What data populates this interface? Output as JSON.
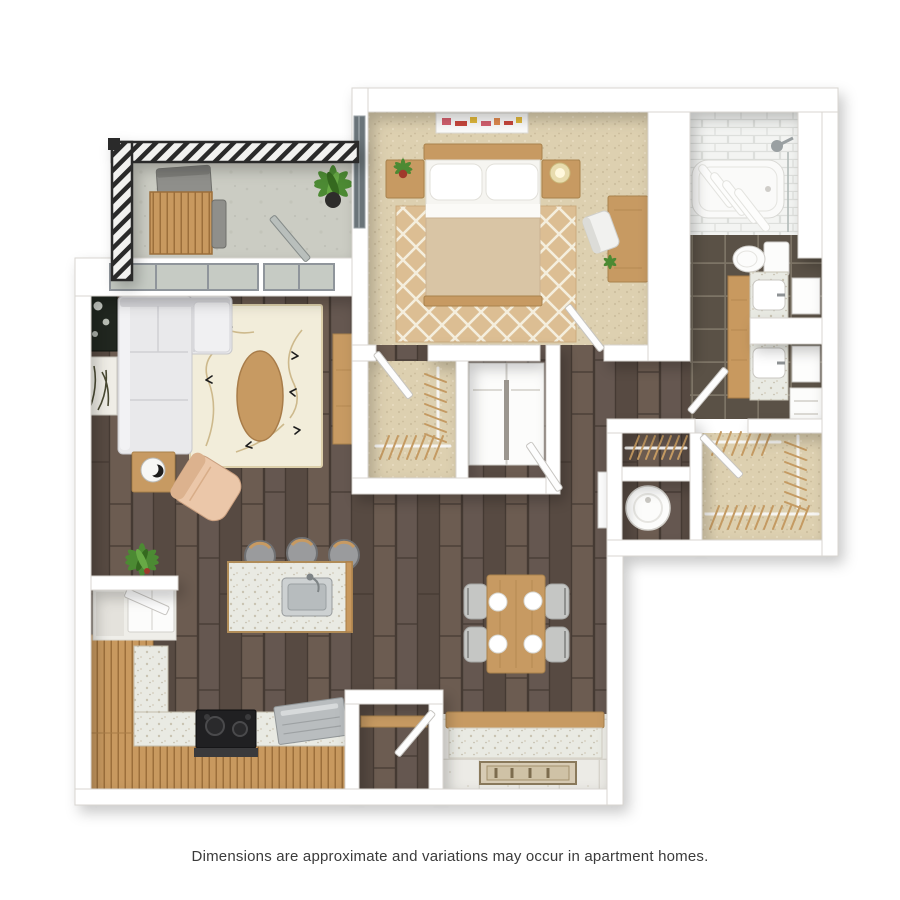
{
  "caption": {
    "text": "Dimensions are approximate and variations may occur in apartment homes."
  },
  "palette": {
    "wall": "#ffffff",
    "wall_edge": "#d8d5d0",
    "wood_floor": "#5e5148",
    "carpet": "#ddd0b0",
    "tile_dark": "#5a5146",
    "tile_grout": "#7d7466",
    "shower_tile": "#f3f4f2",
    "balcony_floor": "#cbccc3",
    "railing": "#2c2c2c",
    "cabinet_wood": "#c8995f",
    "furniture_wood": "#c79a62",
    "counter_speckle": "#e9eae3",
    "sofa": "#e9e9eb",
    "accent_chair": "#ebc7a9",
    "rug_cream": "#f2edda",
    "rug_tan": "#dcbe93",
    "appliance_steel": "#b9bdbf",
    "stove_black": "#202022",
    "door": "#fdfdfd",
    "door_edge": "#c6c4c0",
    "glass": "#c6cbc4",
    "window_frame": "#8f959b",
    "plant_green": "#4c8a33",
    "hanger_wood": "#c49a62",
    "blanket_tan": "#d9c5a5",
    "text": "#3b3b3b"
  },
  "floor_plan": {
    "type": "3d-top-down-apartment-floor-plan",
    "rooms": [
      {
        "name": "balcony",
        "floor": "concrete",
        "items": [
          "railing",
          "bistro-table",
          "patio-chair",
          "potted-plant",
          "glass-door"
        ]
      },
      {
        "name": "living-room",
        "floor": "dark-hardwood",
        "items": [
          "sectional-sofa",
          "area-rug",
          "oval-coffee-table",
          "side-table",
          "accent-chair",
          "wall-art",
          "wall-art",
          "media-console",
          "potted-plant",
          "windows"
        ]
      },
      {
        "name": "kitchen",
        "floor": "dark-hardwood",
        "items": [
          "l-shaped-counter",
          "range-stove",
          "dishwasher",
          "refrigerator",
          "island-with-sink",
          "bar-stool",
          "bar-stool",
          "bar-stool"
        ]
      },
      {
        "name": "dining-area",
        "floor": "dark-hardwood",
        "items": [
          "dining-table",
          "dining-chair",
          "dining-chair",
          "dining-chair",
          "dining-chair",
          "place-setting",
          "place-setting",
          "place-setting",
          "place-setting"
        ]
      },
      {
        "name": "entry",
        "floor": "tile",
        "items": [
          "pony-wall",
          "doormat",
          "pantry-closet",
          "pantry-door"
        ]
      },
      {
        "name": "bedroom",
        "floor": "carpet",
        "items": [
          "bed",
          "pillows",
          "nightstand",
          "nightstand",
          "table-lamp",
          "potted-plant",
          "trellis-rug",
          "desk",
          "desk-chair",
          "wall-art",
          "wall-art",
          "window",
          "door"
        ]
      },
      {
        "name": "bedroom-closet",
        "floor": "carpet",
        "items": [
          "wire-shelving",
          "door"
        ]
      },
      {
        "name": "laundry-closet",
        "floor": "",
        "items": [
          "washer",
          "dryer"
        ]
      },
      {
        "name": "hallway",
        "floor": "dark-hardwood",
        "items": [
          "door"
        ]
      },
      {
        "name": "bathroom",
        "floor": "dark-tile",
        "items": [
          "tub-shower",
          "shower-curtain",
          "shower-head",
          "toilet",
          "vanity",
          "sink",
          "sink",
          "mirror",
          "mirror",
          "linen-cabinet",
          "door"
        ]
      },
      {
        "name": "walk-in-closet",
        "floor": "carpet",
        "items": [
          "wire-shelving",
          "door"
        ]
      },
      {
        "name": "coat-closet",
        "floor": "dark-hardwood",
        "items": [
          "wire-shelving"
        ]
      },
      {
        "name": "utility-closet",
        "floor": "dark-hardwood",
        "items": [
          "water-heater",
          "door"
        ]
      }
    ]
  }
}
